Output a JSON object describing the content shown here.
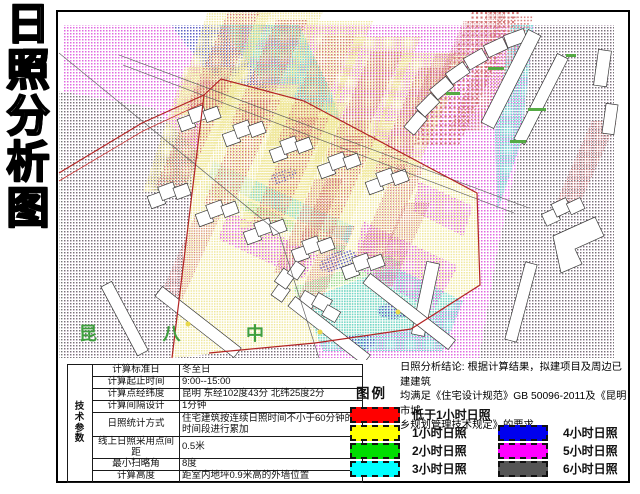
{
  "sheet_title": {
    "text": "日照分析图",
    "chars": [
      "日",
      "照",
      "分",
      "析",
      "图"
    ]
  },
  "map": {
    "school_label": "昆 八 中",
    "site_boundary_color": "#b32424",
    "pattern_colors": {
      "under_1h_red": "#d47878",
      "h1_yellow": "#efe79a",
      "h2_green": "#8fd88f",
      "h3_cyan": "#6fd8cf",
      "h4_blue": "#5f5fc4",
      "h5_magenta": "#e06ae0",
      "h6_gray": "#777777"
    }
  },
  "tech_table": {
    "header": "技术参数",
    "rows": [
      {
        "label": "计算标准日",
        "value": "冬至日"
      },
      {
        "label": "计算起止时间",
        "value": "9:00--15:00"
      },
      {
        "label": "计算点经纬度",
        "value": "昆明 东经102度43分 北纬25度2分"
      },
      {
        "label": "计算间隔设计",
        "value": "1分钟"
      },
      {
        "label": "日照统计方式",
        "value": "住宅建筑按连续日照时间不小于60分钟的时间段进行累加"
      },
      {
        "label": "线上日照采用点间距",
        "value": "0.5米"
      },
      {
        "label": "最小扫略角",
        "value": "8度"
      },
      {
        "label": "计算高度",
        "value": "距室内地坪0.9米高的外墙位置"
      }
    ]
  },
  "legend": {
    "title": "图例",
    "conclusion_lines": [
      "日照分析结论: 根据计算结果，拟建项目及周边已建建筑",
      "均满足《住宅设计规范》GB 50096-2011及《昆明市城",
      "乡规划管理技术规定》的要求。"
    ],
    "items": [
      {
        "label": "低于1小时日照",
        "color": "#ff0000"
      },
      {
        "label": "1小时日照",
        "color": "#ffff00"
      },
      {
        "label": "2小时日照",
        "color": "#00dd00"
      },
      {
        "label": "3小时日照",
        "color": "#00ffff"
      },
      {
        "label": "4小时日照",
        "color": "#0000ee"
      },
      {
        "label": "5小时日照",
        "color": "#ff00ff"
      },
      {
        "label": "6小时日照",
        "color": "#555555"
      }
    ]
  }
}
